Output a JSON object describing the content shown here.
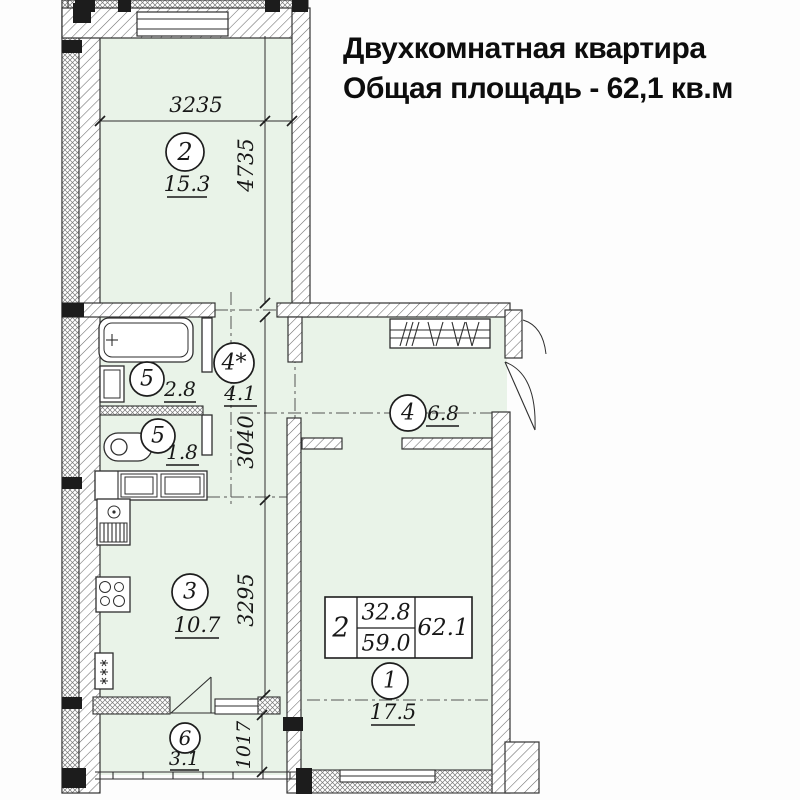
{
  "title": {
    "line1": "Двухкомнатная квартира",
    "line2": "Общая площадь - 62,1 кв.м"
  },
  "plan": {
    "type": "apartment-floor-plan",
    "total_area_sqm": "62,1",
    "rooms": [
      {
        "number": "2",
        "area": "15.3"
      },
      {
        "number": "5",
        "area": "2.8"
      },
      {
        "number": "4*",
        "area": "4.1"
      },
      {
        "number": "5",
        "area": "1.8"
      },
      {
        "number": "4",
        "area": "6.8"
      },
      {
        "number": "3",
        "area": "10.7"
      },
      {
        "number": "1",
        "area": "17.5"
      },
      {
        "number": "6",
        "area": "3.1"
      }
    ],
    "dimensions_mm": {
      "room2_width": "3235",
      "room2_depth": "4735",
      "hall_depth": "3040",
      "kitchen_depth": "3295",
      "balcony_depth": "1017"
    },
    "area_table": {
      "rooms_count": "2",
      "living_area": "32.8",
      "area_no_balcony": "59.0",
      "total_area": "62.1"
    }
  },
  "colors": {
    "room_fill": "#e9f3e8",
    "line": "#333333",
    "background": "#fdfdfd"
  }
}
